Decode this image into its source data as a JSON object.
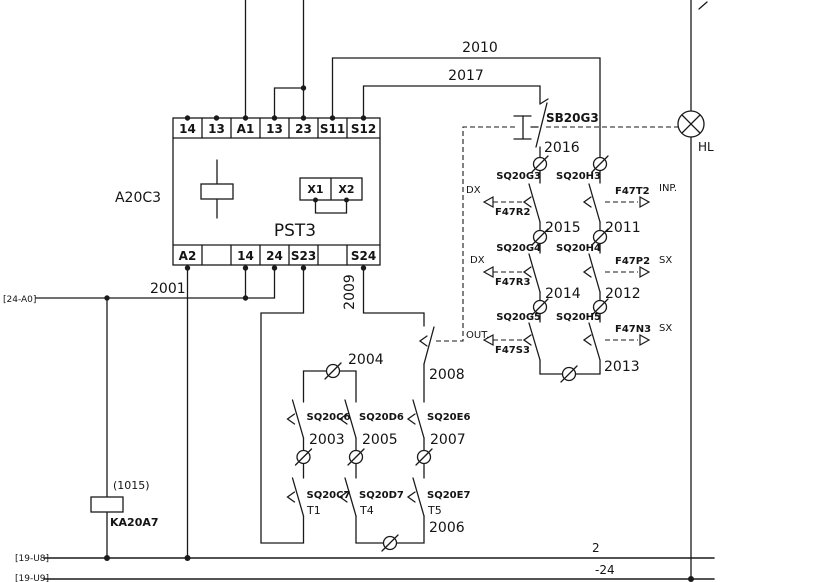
{
  "device": {
    "ref": "A20C3",
    "model": "PST3",
    "top_terminals": [
      "14",
      "13",
      "A1",
      "13",
      "23",
      "S11",
      "S12"
    ],
    "bottom_terminals": [
      "A2",
      "14",
      "24",
      "S23",
      "S24"
    ],
    "aux_terminals": [
      "X1",
      "X2"
    ]
  },
  "wires": {
    "2001": "2001",
    "2003": "2003",
    "2004": "2004",
    "2005": "2005",
    "2006": "2006",
    "2007": "2007",
    "2008": "2008",
    "2009": "2009",
    "2010": "2010",
    "2011": "2011",
    "2012": "2012",
    "2013": "2013",
    "2014": "2014",
    "2015": "2015",
    "2016": "2016",
    "2017": "2017"
  },
  "switches": {
    "sb20g3": "SB20G3",
    "sq20g3": "SQ20G3",
    "sq20h3": "SQ20H3",
    "sq20g4": "SQ20G4",
    "sq20h4": "SQ20H4",
    "sq20g5": "SQ20G5",
    "sq20h5": "SQ20H5",
    "sq20c6": "SQ20C6",
    "sq20d6": "SQ20D6",
    "sq20e6": "SQ20E6",
    "sq20c7": "SQ20C7",
    "sq20d7": "SQ20D7",
    "sq20e7": "SQ20E7"
  },
  "signals": {
    "f47r2": "F47R2",
    "f47t2": "F47T2",
    "f47r3": "F47R3",
    "f47p2": "F47P2",
    "f47s3": "F47S3",
    "f47n3": "F47N3"
  },
  "tags": {
    "dx1": "DX",
    "dx2": "DX",
    "out": "OUT.",
    "inp": "INP.",
    "sx1": "SX",
    "sx2": "SX"
  },
  "timer_labels": {
    "t1": "T1",
    "t4": "T4",
    "t5": "T5"
  },
  "relay": {
    "ref": "KA20A7",
    "code": "(1015)"
  },
  "lamp": {
    "label": "HL"
  },
  "refs": {
    "left": "[24-A0]",
    "bottom1": "[19-U8]",
    "bottom2": "[19-U9]",
    "rail_top": "2",
    "rail_bottom": "-24"
  }
}
